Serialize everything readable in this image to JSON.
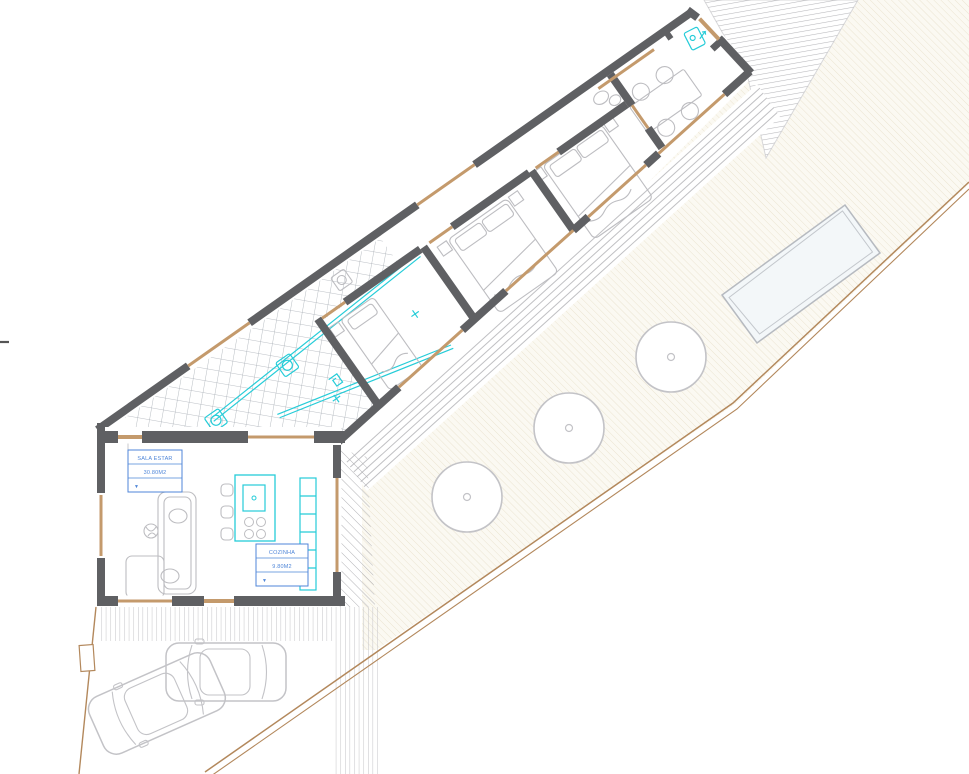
{
  "document": {
    "type": "architectural floor plan",
    "view": "furnished site / floor plan, building rotated on plot"
  },
  "labels": {
    "living": {
      "name": "SALA ESTAR",
      "area": "30.80M2",
      "symbol": "▼"
    },
    "kitchen": {
      "name": "COZINHA",
      "area": "9.80M2",
      "symbol": "▼"
    }
  },
  "palette": {
    "wall_gray": "#5f6063",
    "timber_tan": "#c49a6c",
    "boundary_tan": "#b3885c",
    "plumbing_cyan": "#25ccd8",
    "label_blue": "#4f86d8",
    "furniture_gray": "#bdbdc1",
    "tile_line": "#a6acb4",
    "terrace_hatch": "#ebe4d1",
    "deck_line": "#b7b7ba"
  },
  "site": {
    "bedrooms": 3,
    "beds": [
      "single",
      "double",
      "double"
    ],
    "dining_chairs": 4,
    "kitchen_stools": 3,
    "trees": 3,
    "cars": 2,
    "pool": 1,
    "washing_machines": 3
  }
}
